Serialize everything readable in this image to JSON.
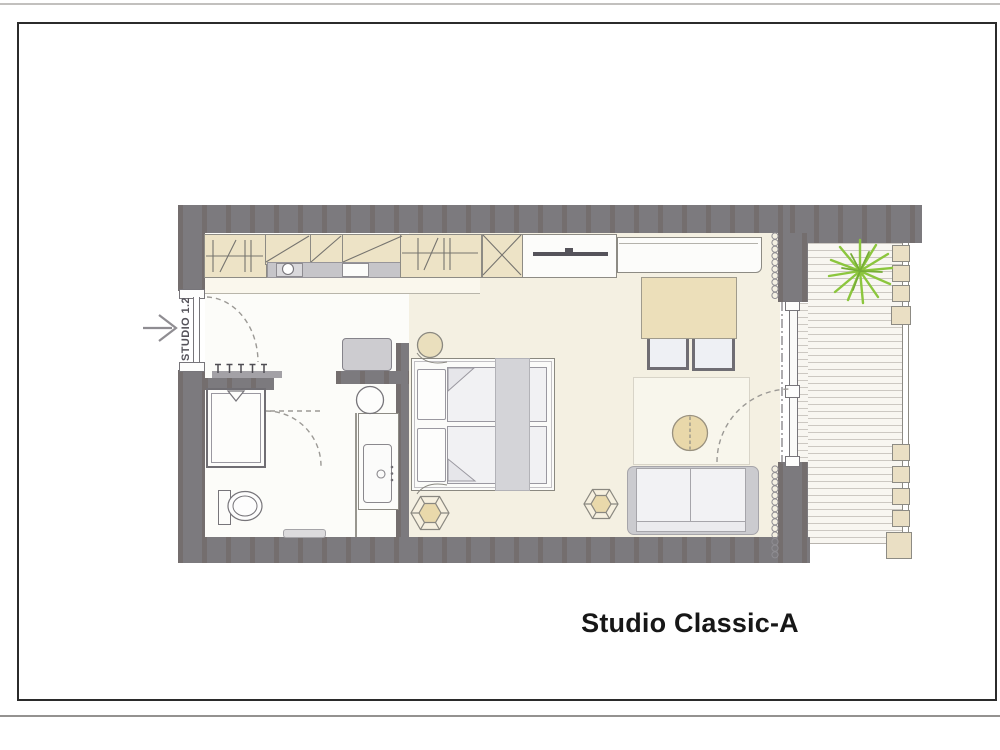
{
  "document": {
    "type": "scanned architectural floor plan",
    "title": "Studio Classic-A"
  },
  "entrance": {
    "unit_label": "STUDIO 1.2",
    "direction_arrow": "points right into entry door"
  },
  "rooms": [
    "entry-hall",
    "bathroom",
    "kitchenette-niche",
    "sleeping-area",
    "living-area",
    "balcony"
  ],
  "furniture": [
    "wardrobe-hanging-section",
    "kitchenette-upper-cabinets",
    "kitchenette-counter",
    "kitchen-sink",
    "kitchen-cooktop",
    "wardrobe-hanging-section-2",
    "shelf-x-unit",
    "tv-unit",
    "tv",
    "sideboard",
    "dining-table",
    "dining-chair",
    "dining-chair",
    "round-table",
    "rug",
    "sofa",
    "hexagon-side-table",
    "hexagon-side-table",
    "double-bed",
    "pillow",
    "pillow",
    "duvet",
    "duvet",
    "bed-runner",
    "round-stool",
    "desk",
    "laptop",
    "desk-chair",
    "washbasin-counter",
    "shower",
    "toilet",
    "bath-mat",
    "coat-hooks",
    "balcony-tree",
    "planter-box"
  ],
  "balcony": {
    "planter_boxes": 9,
    "tree": "deciduous top view",
    "deck": "wood plank decking"
  },
  "doors": [
    "entry-door-swing",
    "bathroom-door-swing",
    "balcony-door-swing",
    "balcony-glass-door"
  ],
  "palette": {
    "wall_gray": "#7c7a7e",
    "unit_beige": "#ede3c6",
    "floor_cream": "#f4f0e2",
    "floor_white": "#fcfcf9",
    "counter_gray": "#c6c5c9",
    "tree_green": "#8cc63e",
    "sofa_gray": "#cbcbcf",
    "table_beige": "#e9d8aa",
    "frame_black": "#2b2b2b",
    "dash_gray": "#9b9995"
  }
}
